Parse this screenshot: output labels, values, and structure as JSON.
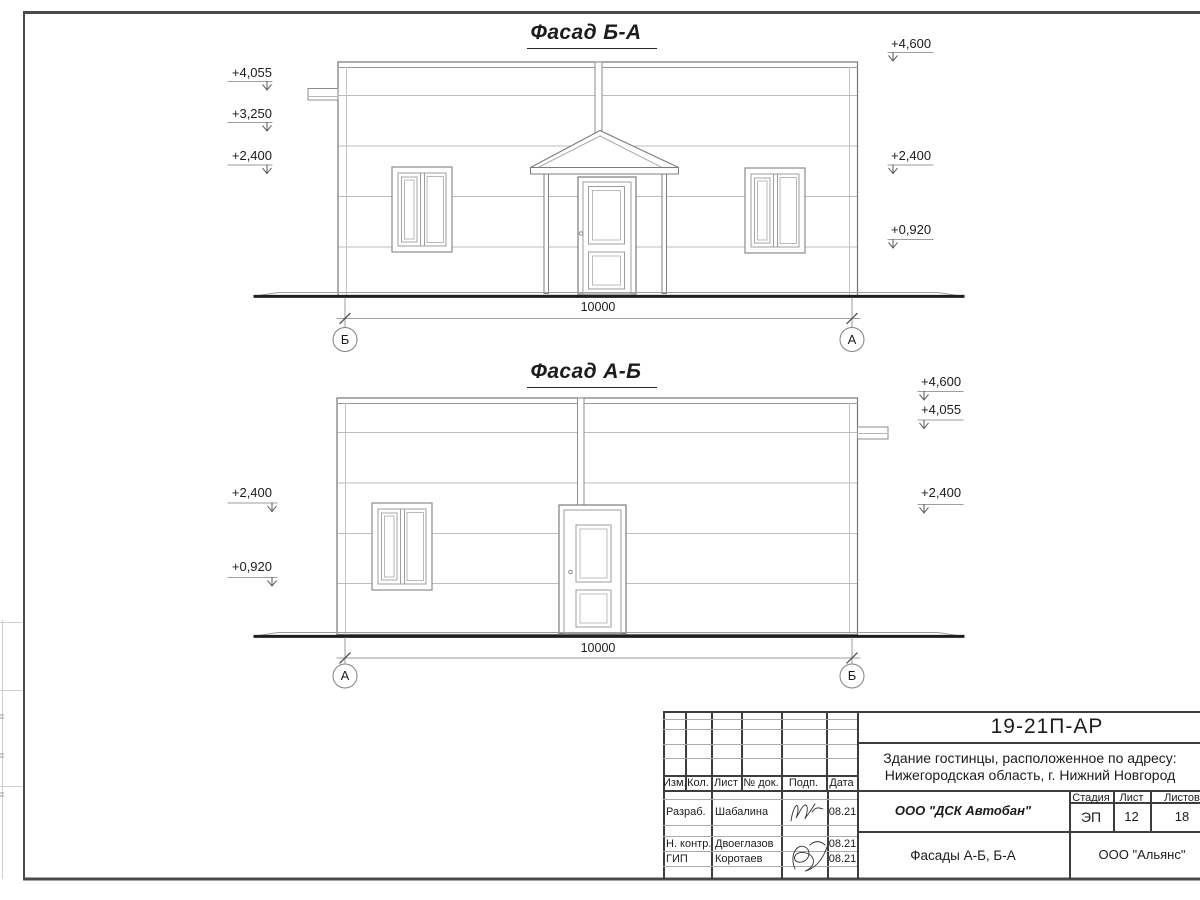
{
  "sheet": {
    "facade1": {
      "title": "Фасад Б-А",
      "dimension": "10000",
      "axis_left": "Б",
      "axis_right": "А",
      "marks_left": [
        "+4,055",
        "+3,250",
        "+2,400"
      ],
      "marks_right": [
        "+4,600",
        "+2,400",
        "+0,920"
      ]
    },
    "facade2": {
      "title": "Фасад А-Б",
      "dimension": "10000",
      "axis_left": "А",
      "axis_right": "Б",
      "marks_left": [
        "+2,400",
        "+0,920"
      ],
      "marks_right": [
        "+4,600",
        "+4,055",
        "+2,400"
      ]
    },
    "title_block": {
      "doc_number": "19-21П-АР",
      "object_address_line1": "Здание гостинцы, расположенное по адресу:",
      "object_address_line2": "Нижегородская область, г. Нижний Новгород",
      "table_columns": [
        "Изм.",
        "Кол.",
        "Лист",
        "№ док.",
        "Подп.",
        "Дата"
      ],
      "signature_rows": [
        {
          "role": "Разраб.",
          "name": "Шабалина",
          "date": "08.21"
        },
        {
          "role": "Н. контр.",
          "name": "Двоеглазов",
          "date": "08.21"
        },
        {
          "role": "ГИП",
          "name": "Коротаев",
          "date": "08.21"
        }
      ],
      "developer_company": "ООО \"ДСК Автобан\"",
      "stage_label": "Стадия",
      "sheet_label": "Лист",
      "sheets_label": "Листов",
      "stage_value": "ЭП",
      "sheet_value": "12",
      "sheets_value": "18",
      "drawing_title": "Фасады А-Б, Б-А",
      "contractor_company": "ООО \"Альянс\""
    }
  }
}
